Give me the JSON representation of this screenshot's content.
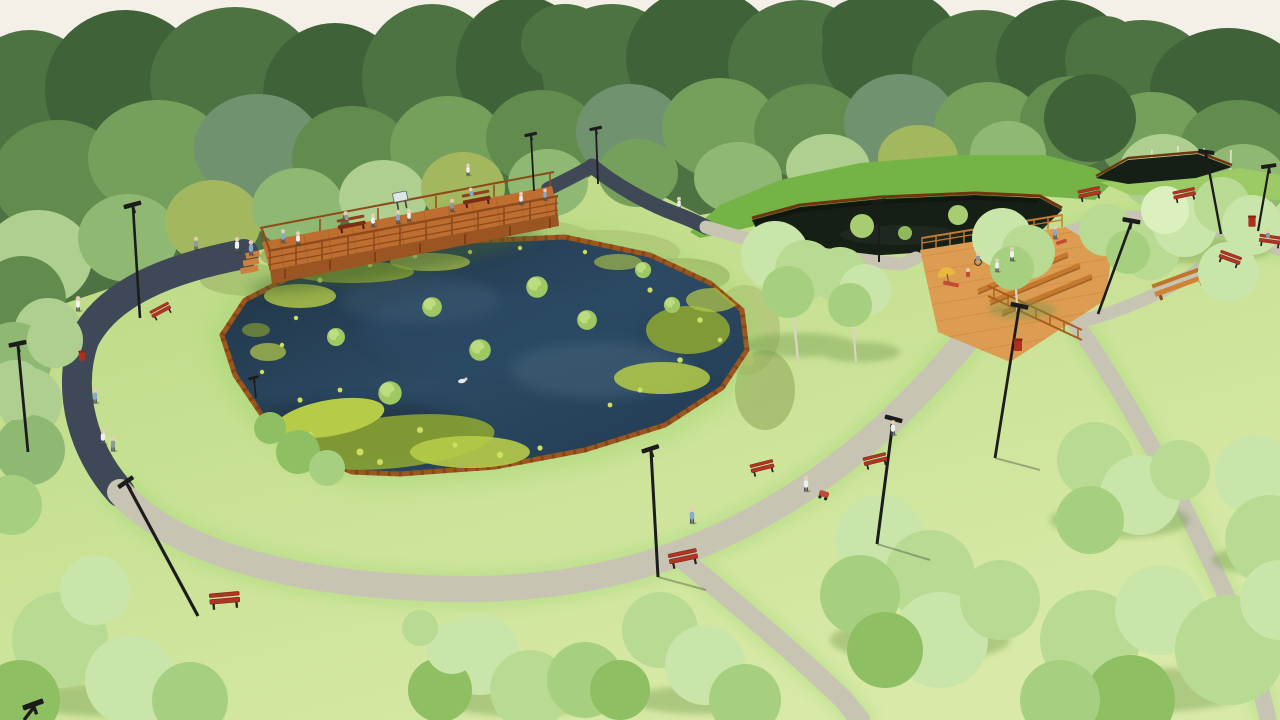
{
  "scene": {
    "title": "Aerial park visualization",
    "description": "Aerial 3D architectural rendering of a landscaped public park: a large lily-covered pond with corten steel edging, a raised timber boardwalk with railings, benches and an info sign, a second dark woodland pond beneath a grassy bank, a tiered timber seating deck, curving asphalt and gravel footpaths lined with red benches, solar street lamps, litter bins, scattered trees and strolling visitors, all framed by a dense tree belt under a pale sky."
  },
  "palette": {
    "sky": "#f4efe7",
    "far_field_light": "#edf0dc",
    "far_field": "#dde6c8",
    "grass_a": "#b9d77f",
    "grass_b": "#c6e092",
    "grass_c": "#d8e9a8",
    "grass_glow": "#a6d977",
    "bank_green": "#74b446",
    "meadow": "#b3c47b",
    "meadow_dark": "#93aa5b",
    "sedge": "#b7b86a",
    "forest_darkest": "#3f6239",
    "forest_dark": "#4d7343",
    "forest_mid": "#618c4e",
    "forest_mid2": "#75a05c",
    "forest_blue": "#71926f",
    "forest_light": "#8fb873",
    "forest_pale": "#aecf8f",
    "forest_yellow": "#a3b85e",
    "tree1": "#b9da92",
    "tree2": "#c9e5a9",
    "tree3": "#a6d07f",
    "tree_hi": "#dcefbf",
    "tree_dk": "#8fbf63",
    "trunk": "#d9d3c0",
    "water_dark": "#1f3143",
    "water_mid": "#2c4a63",
    "water_light": "#48697f",
    "pond2_water": "#161f16",
    "corten": "#9c561e",
    "corten_dark": "#6e350e",
    "lily": "#b6cc48",
    "lily_light": "#ccdf63",
    "lily_dark": "#8fa930",
    "tuft": "#9fc763",
    "tuft_light": "#bcdc80",
    "path_dark": "#3f4856",
    "path_light": "#c7c4b4",
    "wood": "#bd6e30",
    "wood_light": "#cd7f3d",
    "wood_dark": "#8e4a1b",
    "deck2": "#dc9c52",
    "deck2_bench": "#c5792f",
    "bench_red": "#b13524",
    "bench_dark": "#7c1f12",
    "bin_red": "#ac3020",
    "lamp": "#1c1c1c",
    "shadow_green": "#6f9a4a",
    "person_white": "#eef0ef",
    "person_blue": "#85aacb",
    "person_gray": "#8e989e",
    "person_red": "#bf4b38"
  },
  "objects": {
    "main_pond": {
      "label": "lily pond",
      "edging": "corten steel",
      "lily_clusters": 5,
      "grass_islands": 8,
      "ducks": 1
    },
    "upper_pond": {
      "label": "dark woodland pond",
      "edging": "corten steel",
      "shrub_islands": 3
    },
    "boardwalk": {
      "label": "timber boardwalk",
      "benches": 2,
      "info_signs": 1
    },
    "seating_deck": {
      "label": "tiered timber deck",
      "long_benches": 3,
      "backed_benches": 2,
      "loungers": 3,
      "umbrellas": 1
    },
    "paths": {
      "asphalt_loop": 1,
      "gravel_walks": 5
    },
    "street_lamps": 14,
    "path_benches": 9,
    "litter_bins": 3,
    "people": 28,
    "strollers": 1,
    "trees_foreground_clusters": 14
  }
}
